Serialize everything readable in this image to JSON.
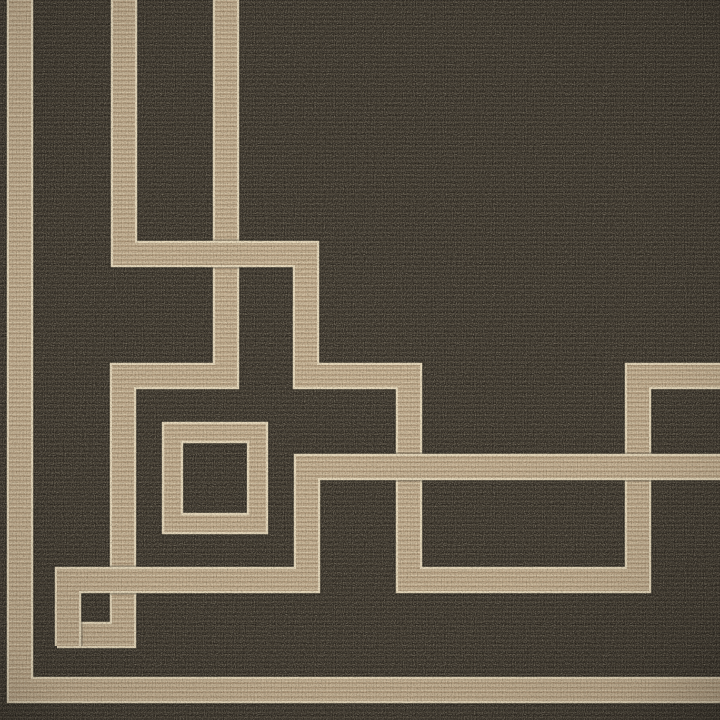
{
  "meta": {
    "title": "Flatweave rug corner photograph",
    "subject": "area rug with geometric Greek-key border",
    "canvas": {
      "width": 720,
      "height": 720
    }
  },
  "palette": {
    "field_base": "#39332b",
    "field_row_dark": "#2b2620",
    "field_row_mid": "#463f34",
    "field_row_deep": "#2f2a23",
    "field_fleck": "#57503e",
    "field_stitch_shadow": "rgba(0,0,0,0.20)",
    "band_base": "#c0a98b",
    "band_row_light": "#d9c8aa",
    "band_row_dark": "#aa9274",
    "band_row_soft": "#cfbd9f",
    "band_stitch_shadow": "rgba(90,70,45,0.18)",
    "band_edge_cream": "#e9dbbe",
    "band_seam_shadow": "rgba(16,12,7,0.38)"
  },
  "pattern_geometry": {
    "band_width": 22,
    "edge_width": 26.5,
    "seam_width": 29,
    "paths": [
      {
        "name": "frame-stripe-left-bottom",
        "d": "M 20,0 L 20,690 L 720,690"
      },
      {
        "name": "greek-fret-line-a",
        "d": "M 124,0 L 124,254 L 306,254 L 306,376 L 409,376 L 409,580 L 638,580 L 638,376 L 720,376"
      },
      {
        "name": "greek-fret-line-b-hook",
        "d": "M 226,0 L 226,376 L 123,376 L 123,635 L 57,635"
      },
      {
        "name": "fret-crossing-patch",
        "d": "M 205,254 L 255,254"
      },
      {
        "name": "greek-fret-line-b-return",
        "d": "M 68,646 L 68,580 L 307,580 L 307,467 L 720,467"
      }
    ],
    "concentric_square": {
      "name": "concentric-square-motif",
      "outer": {
        "x": 163,
        "y": 423,
        "w": 104,
        "h": 110
      },
      "inner_hole": {
        "x": 182,
        "y": 442,
        "w": 66,
        "h": 72
      }
    }
  },
  "description": "Corner detail of a dark charcoal-brown flatweave rug with a tan Greek-key border: a frame stripe along the left edge turning across the bottom, two interlocking fret lines descending from the top edge and stepping toward the lower right, a concentric square medallion left of center, and a small open square motif near the bottom-left corner."
}
